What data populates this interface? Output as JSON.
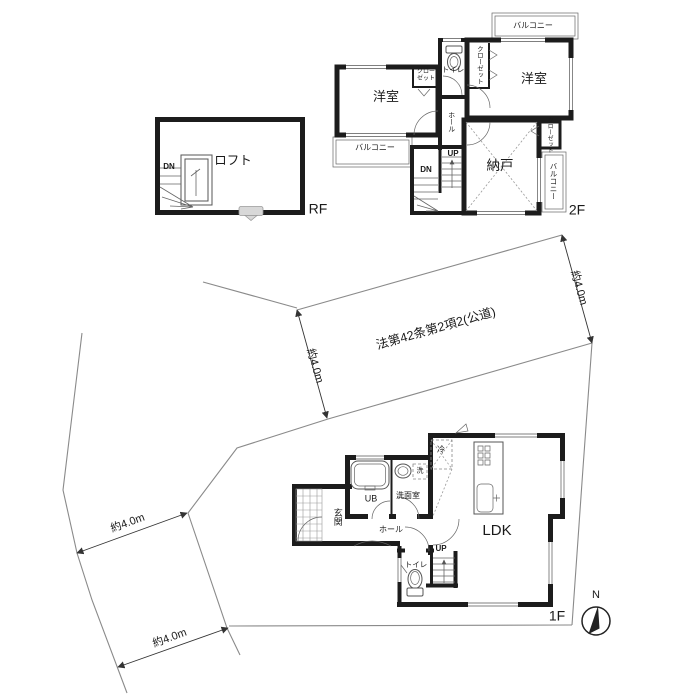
{
  "colors": {
    "wall": "#1c1c1c",
    "boundary_line": "#8a8a8a",
    "dimension_line": "#333333",
    "text": "#1a1a1a",
    "vent_gray": "#d8d8d8",
    "background": "#ffffff"
  },
  "rf": {
    "floor_label": "RF",
    "loft": "ロフト",
    "dn": "DN"
  },
  "f2": {
    "floor_label": "2F",
    "balcony_top": "バルコニー",
    "balcony_left": "バルコニー",
    "balcony_right": "バルコニー",
    "yoshitsu_left": "洋室",
    "yoshitsu_right": "洋室",
    "closet_left_line1": "クロー",
    "closet_left_line2": "ゼット",
    "closet_right": "クローゼット",
    "closet_nando": "クローゼット",
    "toilet": "トイレ",
    "hall": "ホール",
    "nando": "納戸",
    "up": "UP",
    "dn": "DN"
  },
  "f1": {
    "floor_label": "1F",
    "genkan": "玄関",
    "ub": "UB",
    "senmenshitsu": "洗面室",
    "washer": "洗",
    "hall": "ホール",
    "toilet": "トイレ",
    "up": "UP",
    "ldk": "LDK",
    "fridge": "冷"
  },
  "site": {
    "road": "法第42条第2項2(公道)",
    "dim_road_left": "約4.0m",
    "dim_road_right": "約4.0m",
    "dim_west": "約4.0m",
    "dim_south": "約4.0m"
  },
  "compass": {
    "n": "N"
  }
}
